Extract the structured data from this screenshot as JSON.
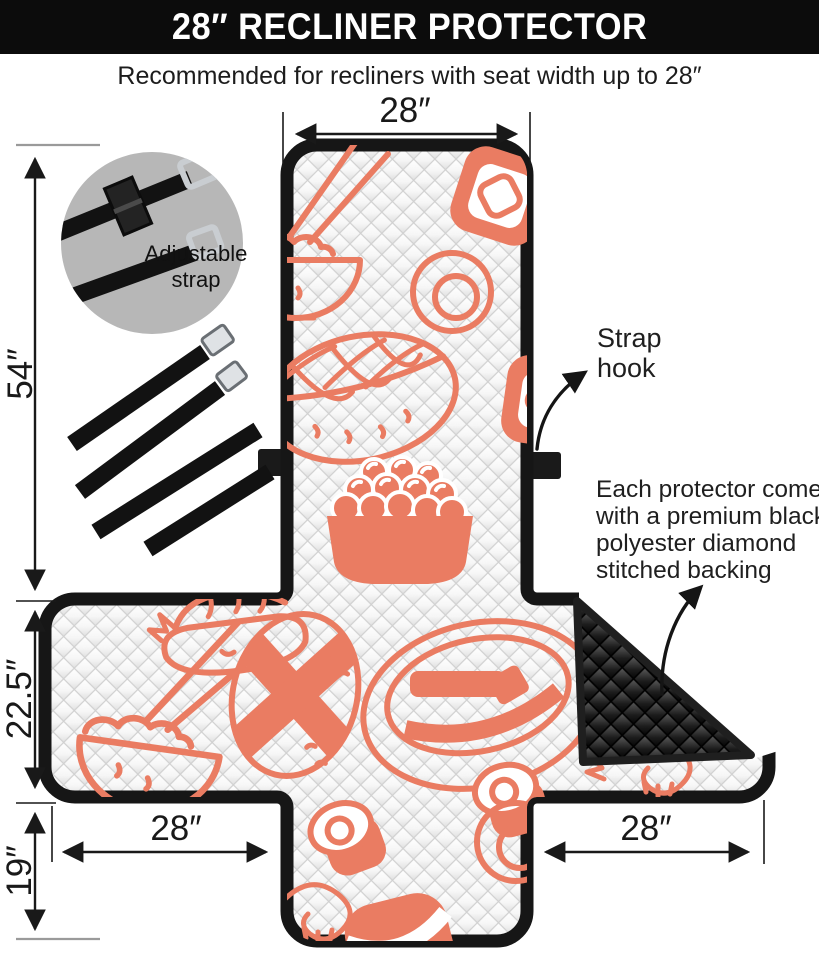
{
  "header": {
    "title": "28″ RECLINER PROTECTOR"
  },
  "subtitle": "Recommended for recliners with seat width up to 28″",
  "dimensions": {
    "top_width": "28″",
    "back_height": "54″",
    "wing_height": "22.5″",
    "front_drop": "19″",
    "bottom_left_width": "28″",
    "bottom_right_width": "28″"
  },
  "callouts": {
    "adjustable_line1": "Adjustable",
    "adjustable_line2": "strap",
    "strap_hook_line1": "Strap",
    "strap_hook_line2": "hook",
    "backing_lines": [
      "Each protector comes",
      "with a premium black",
      "polyester diamond",
      "stitched backing"
    ]
  },
  "colors": {
    "accent": "#ea7c62",
    "backing": "#1f1f1f",
    "header_bg": "#0c0c0c",
    "text": "#191919",
    "inset_bg": "#b7b7b7",
    "border": "#161616",
    "tick_gray": "#9a9a9a"
  }
}
